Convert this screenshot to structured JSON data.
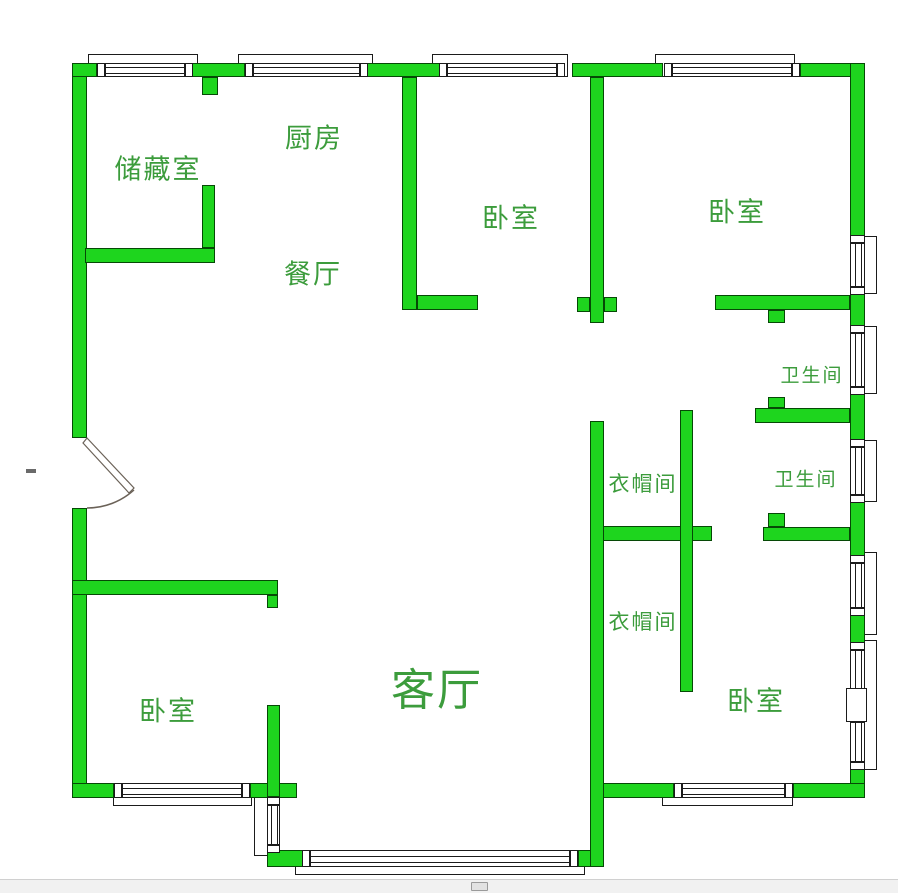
{
  "title": "residential floor plan",
  "colors": {
    "wall_fill": "#1ED51E",
    "wall_border": "#064906",
    "line": "#1b1b1b",
    "label": "#3C9C3C",
    "background": "#ffffff"
  },
  "labels": [
    {
      "key": "storage-room",
      "text": "储藏室",
      "x": 158,
      "y": 167,
      "size": 27
    },
    {
      "key": "kitchen",
      "text": "厨房",
      "x": 314,
      "y": 136,
      "size": 27
    },
    {
      "key": "dining-room",
      "text": "餐厅",
      "x": 313,
      "y": 272,
      "size": 27
    },
    {
      "key": "bedroom-north",
      "text": "卧室",
      "x": 511,
      "y": 216,
      "size": 27
    },
    {
      "key": "bedroom-northeast",
      "text": "卧室",
      "x": 737,
      "y": 210,
      "size": 27
    },
    {
      "key": "bathroom-upper",
      "text": "卫生间",
      "x": 812,
      "y": 374,
      "size": 19
    },
    {
      "key": "bathroom-lower",
      "text": "卫生间",
      "x": 806,
      "y": 478,
      "size": 19
    },
    {
      "key": "closet-upper",
      "text": "衣帽间",
      "x": 643,
      "y": 483,
      "size": 21
    },
    {
      "key": "closet-lower",
      "text": "衣帽间",
      "x": 643,
      "y": 621,
      "size": 21
    },
    {
      "key": "bedroom-southwest",
      "text": "卧室",
      "x": 168,
      "y": 709,
      "size": 27
    },
    {
      "key": "living-room",
      "text": "客厅",
      "x": 437,
      "y": 686,
      "size": 44
    },
    {
      "key": "bedroom-southeast",
      "text": "卧室",
      "x": 756,
      "y": 699,
      "size": 27
    }
  ],
  "walls": [
    [
      72,
      63,
      15,
      375
    ],
    [
      72,
      508,
      15,
      290
    ],
    [
      72,
      63,
      25,
      14
    ],
    [
      192,
      63,
      53,
      14
    ],
    [
      202,
      77,
      16,
      18
    ],
    [
      367,
      63,
      73,
      14
    ],
    [
      572,
      63,
      91,
      14
    ],
    [
      800,
      63,
      65,
      14
    ],
    [
      850,
      63,
      15,
      180
    ],
    [
      850,
      287,
      15,
      46
    ],
    [
      850,
      387,
      15,
      60
    ],
    [
      850,
      495,
      15,
      68
    ],
    [
      850,
      608,
      15,
      42
    ],
    [
      850,
      762,
      15,
      36
    ],
    [
      72,
      783,
      42,
      15
    ],
    [
      250,
      783,
      47,
      15
    ],
    [
      267,
      705,
      13,
      92
    ],
    [
      267,
      845,
      13,
      22
    ],
    [
      267,
      850,
      43,
      17
    ],
    [
      578,
      850,
      25,
      17
    ],
    [
      590,
      783,
      84,
      15
    ],
    [
      793,
      783,
      72,
      15
    ],
    [
      202,
      185,
      13,
      63
    ],
    [
      85,
      248,
      130,
      15
    ],
    [
      402,
      77,
      15,
      233
    ],
    [
      417,
      295,
      61,
      15
    ],
    [
      590,
      77,
      14,
      246
    ],
    [
      577,
      297,
      13,
      15
    ],
    [
      604,
      297,
      13,
      15
    ],
    [
      715,
      295,
      135,
      15
    ],
    [
      768,
      310,
      17,
      13
    ],
    [
      755,
      408,
      95,
      15
    ],
    [
      768,
      397,
      17,
      11
    ],
    [
      590,
      526,
      122,
      15
    ],
    [
      763,
      527,
      87,
      14
    ],
    [
      768,
      513,
      17,
      14
    ],
    [
      590,
      421,
      14,
      446
    ],
    [
      680,
      410,
      13,
      282
    ],
    [
      72,
      580,
      206,
      15
    ],
    [
      267,
      595,
      11,
      13
    ]
  ],
  "frames": [
    [
      88,
      54,
      110,
      23
    ],
    [
      238,
      54,
      135,
      23
    ],
    [
      432,
      54,
      136,
      23
    ],
    [
      655,
      54,
      140,
      23
    ],
    [
      864,
      236,
      13,
      58
    ],
    [
      864,
      326,
      13,
      68
    ],
    [
      864,
      440,
      13,
      62
    ],
    [
      864,
      552,
      13,
      83
    ],
    [
      864,
      640,
      13,
      130
    ],
    [
      113,
      790,
      139,
      16
    ],
    [
      295,
      860,
      290,
      15
    ],
    [
      662,
      790,
      131,
      16
    ],
    [
      254,
      797,
      26,
      59
    ]
  ],
  "windows": [
    {
      "dir": "h",
      "r": [
        105,
        63,
        80,
        14
      ]
    },
    {
      "dir": "h",
      "r": [
        253,
        63,
        107,
        14
      ]
    },
    {
      "dir": "h",
      "r": [
        447,
        63,
        110,
        14
      ]
    },
    {
      "dir": "h",
      "r": [
        672,
        63,
        120,
        14
      ]
    },
    {
      "dir": "h",
      "r": [
        122,
        783,
        120,
        15
      ]
    },
    {
      "dir": "h",
      "r": [
        310,
        850,
        260,
        17
      ]
    },
    {
      "dir": "h",
      "r": [
        682,
        783,
        103,
        15
      ]
    },
    {
      "dir": "v",
      "r": [
        850,
        243,
        15,
        44
      ]
    },
    {
      "dir": "v",
      "r": [
        850,
        333,
        15,
        54
      ]
    },
    {
      "dir": "v",
      "r": [
        850,
        447,
        15,
        48
      ]
    },
    {
      "dir": "v",
      "r": [
        850,
        563,
        15,
        45
      ]
    },
    {
      "dir": "v",
      "r": [
        850,
        650,
        15,
        40
      ]
    },
    {
      "dir": "v",
      "r": [
        850,
        722,
        15,
        40
      ]
    },
    {
      "dir": "v",
      "r": [
        267,
        805,
        13,
        40
      ]
    }
  ],
  "boxes": [
    [
      846,
      688,
      21,
      34
    ]
  ],
  "door": {
    "arc_path": "M134 490 A70 70 0 0 1 87 508",
    "leaf_points": "87,438 134,488 129,493 83,443"
  },
  "stray_mark": [
    26,
    469,
    10,
    4
  ],
  "scrollbar": {
    "thumb_x": 471,
    "thumb_w": 17
  }
}
